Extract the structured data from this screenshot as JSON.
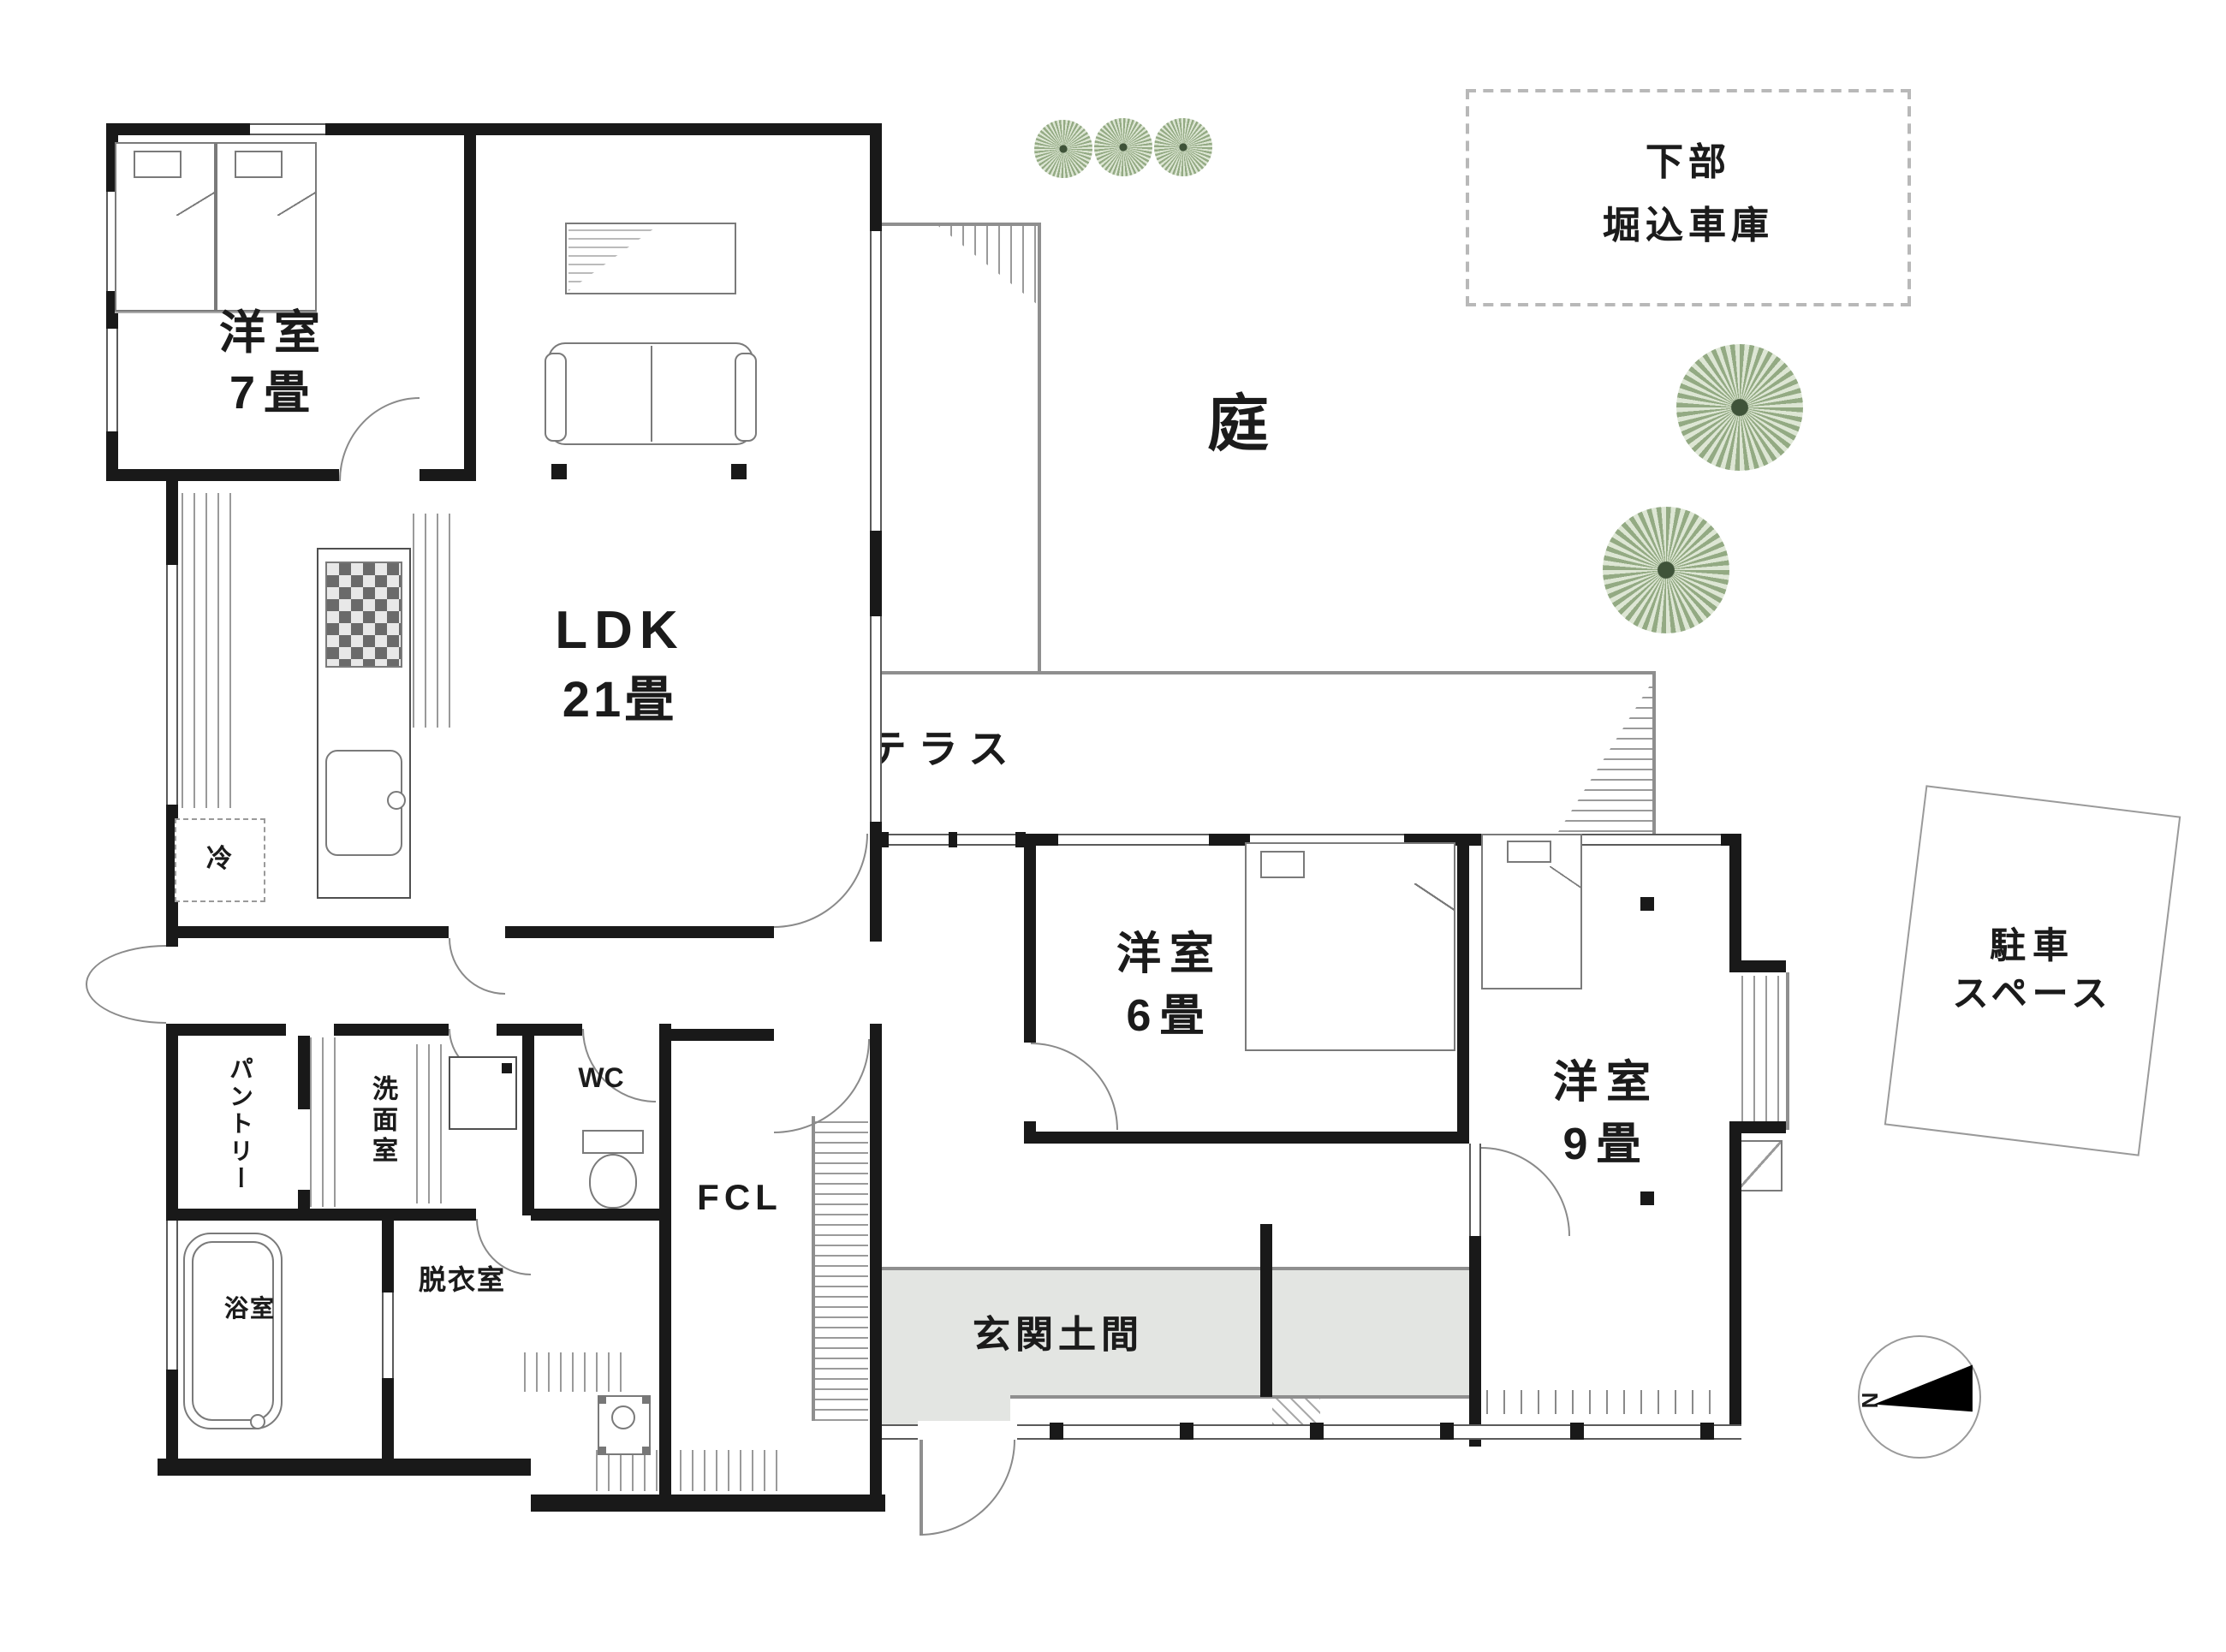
{
  "plan": {
    "rooms": {
      "bedroom7": {
        "line1": "洋室",
        "line2": "7畳"
      },
      "ldk": {
        "line1": "LDK",
        "line2": "21畳"
      },
      "bedroom6": {
        "line1": "洋室",
        "line2": "6畳"
      },
      "bedroom9": {
        "line1": "洋室",
        "line2": "9畳"
      },
      "terrace": {
        "label": "テラス"
      },
      "garden": {
        "label": "庭"
      },
      "garage": {
        "line1": "下部",
        "line2": "堀込車庫"
      },
      "parking": {
        "line1": "駐車",
        "line2": "スペース"
      },
      "genkan": {
        "label": "玄関土間"
      },
      "fcl": {
        "label": "FCL"
      },
      "wc": {
        "label": "WC"
      },
      "senmen": {
        "label": "洗面室"
      },
      "pantry": {
        "label": "パントリー"
      },
      "datsui": {
        "label": "脱衣室"
      },
      "bath": {
        "label": "浴室"
      },
      "fridge": {
        "label": "冷"
      }
    },
    "compass": {
      "north": "N"
    },
    "colors": {
      "wall": "#191919",
      "thin_line": "#8f8f8f",
      "genkan_floor": "#e3e5e2",
      "tree_fill": "#93aa83",
      "tree_light": "#dde6d4",
      "text": "#1b1b1b"
    }
  }
}
